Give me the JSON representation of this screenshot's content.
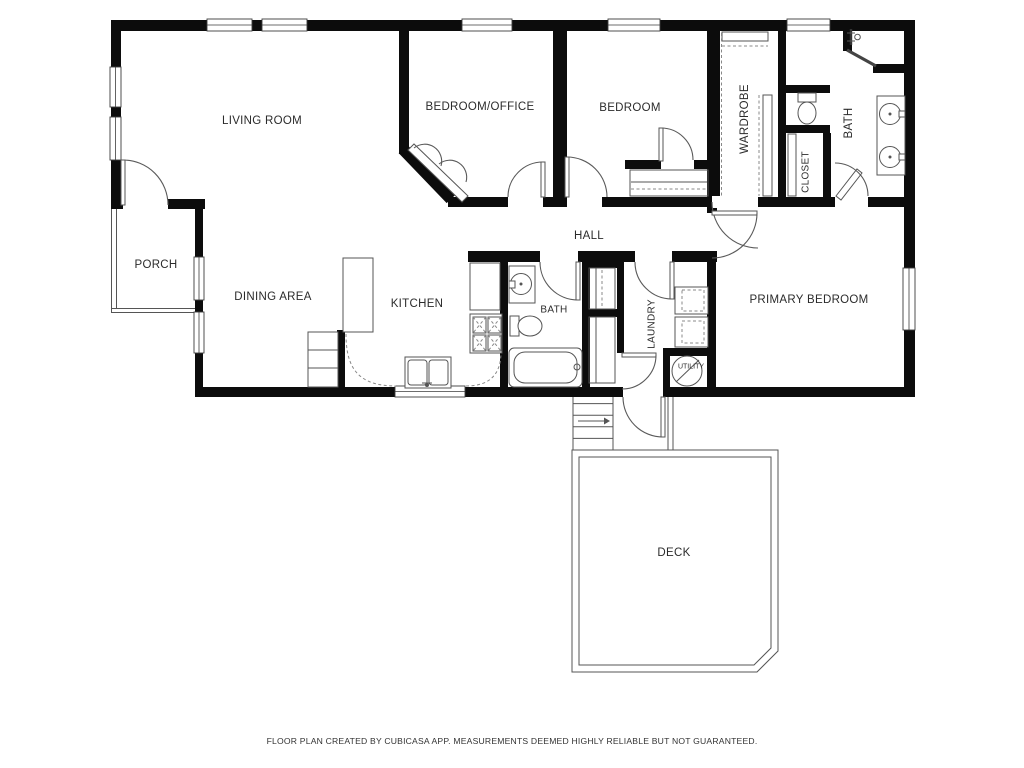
{
  "footer": {
    "disclaimer": "FLOOR PLAN CREATED BY CUBICASA APP. MEASUREMENTS DEEMED HIGHLY RELIABLE BUT NOT GUARANTEED."
  },
  "rooms": {
    "living_room": "LIVING ROOM",
    "bedroom_office": "BEDROOM/OFFICE",
    "bedroom": "BEDROOM",
    "wardrobe": "WARDROBE",
    "closet": "CLOSET",
    "bath_top": "BATH",
    "hall": "HALL",
    "porch": "PORCH",
    "dining_area": "DINING AREA",
    "kitchen": "KITCHEN",
    "bath_mid": "BATH",
    "laundry": "LAUNDRY",
    "utility": "UTILITY",
    "primary_bedroom": "PRIMARY BEDROOM",
    "deck": "DECK"
  },
  "icons": {
    "toilet": "toilet top view",
    "sink": "round basin with faucet",
    "double_vanity": "two round basins",
    "bathtub": "oval tub",
    "shower": "shower head with glass panel",
    "stove": "4-burner cooktop",
    "kitchen_sink": "double basin sink",
    "washer": "laundry machine",
    "dryer": "laundry machine",
    "water_heater": "circle with slash",
    "stairs": "steps with direction arrow"
  },
  "colors": {
    "wall": "#0c0c0c",
    "fixture_line": "#555555",
    "text": "#2b2b2b"
  }
}
